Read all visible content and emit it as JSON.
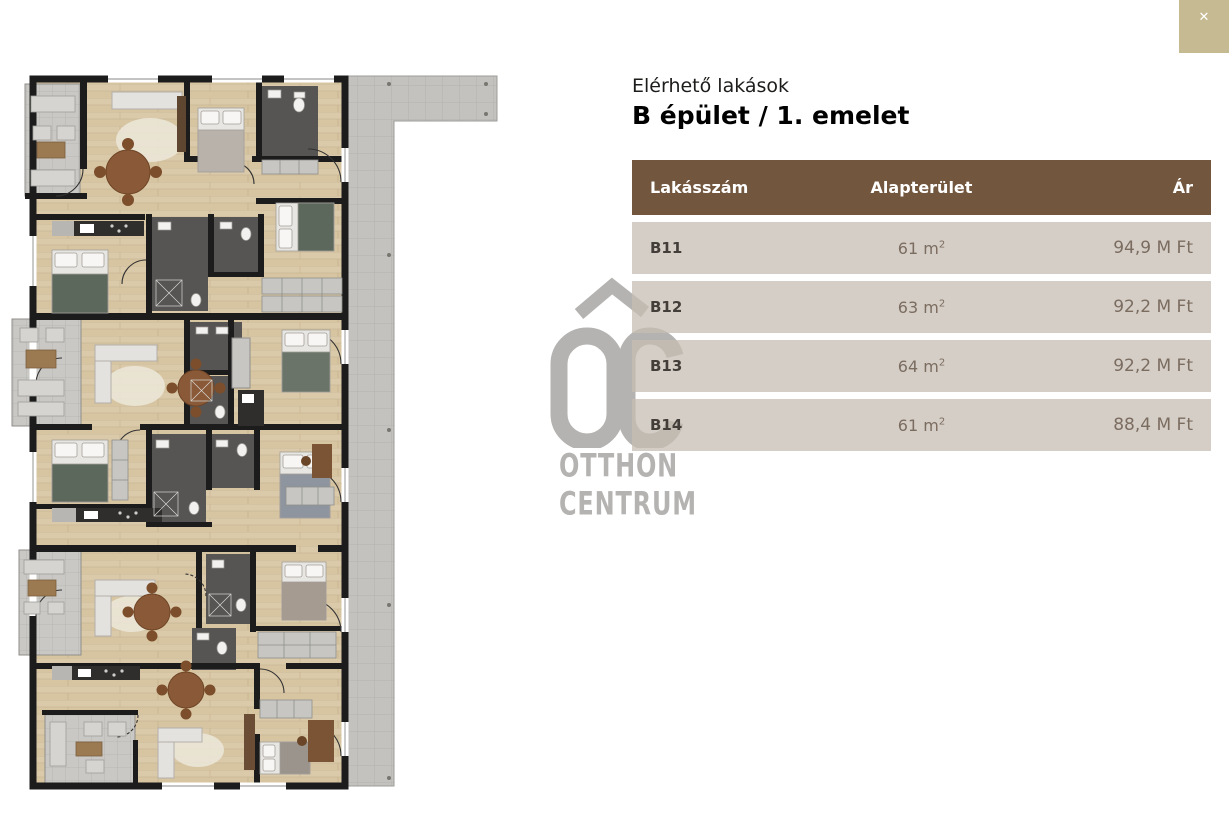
{
  "modal": {
    "close_icon": "✕"
  },
  "logo": {
    "line1": "OTTHON",
    "line2": "CENTRUM"
  },
  "panel": {
    "subtitle": "Elérhető lakások",
    "title": "B épület / 1. emelet",
    "table": {
      "columns": [
        {
          "key": "lakasszam",
          "label": "Lakásszám"
        },
        {
          "key": "alapterulet",
          "label": "Alapterület"
        },
        {
          "key": "ar",
          "label": "Ár"
        }
      ],
      "rows": [
        {
          "num": "B11",
          "area": "61 m",
          "area_sup": "2",
          "price": "94,9 M Ft"
        },
        {
          "num": "B12",
          "area": "63 m",
          "area_sup": "2",
          "price": "92,2 M Ft"
        },
        {
          "num": "B13",
          "area": "64 m",
          "area_sup": "2",
          "price": "92,2 M Ft"
        },
        {
          "num": "B14",
          "area": "61 m",
          "area_sup": "2",
          "price": "88,4 M Ft"
        }
      ]
    }
  },
  "colors": {
    "header_brown": "#72563e",
    "row_beige": "#d5cdc6",
    "close_tan": "#c6ba93",
    "logo_gray": "#b5b3b1",
    "wood_floor": "#dbcaa9",
    "terrace_gray": "#c9c8c5"
  }
}
